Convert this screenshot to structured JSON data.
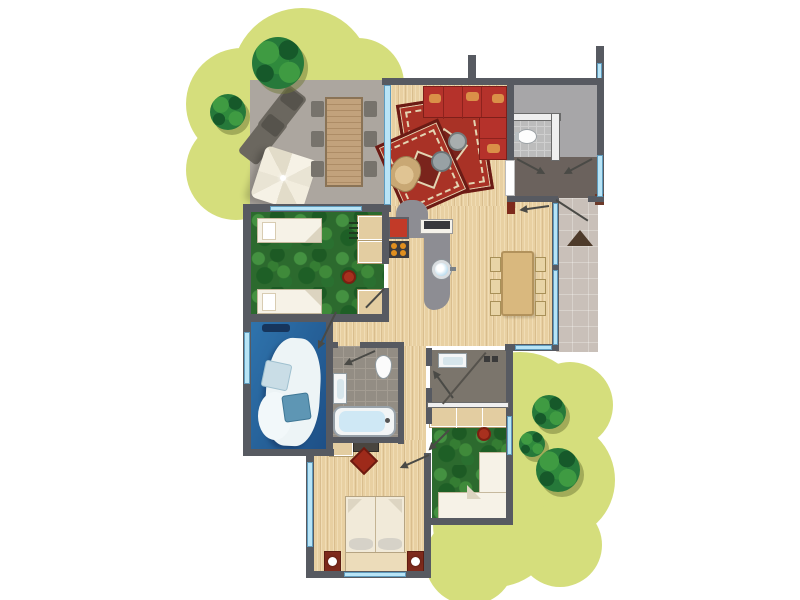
{
  "document": {
    "type": "holiday-home floor plan, top-down illustrated view",
    "visible_text": []
  },
  "palette": {
    "background": "#ffffff",
    "garden": "#d5de7c",
    "tree": "#26793a",
    "terrace_floor": "#aca69f",
    "wall": "#575a61",
    "window": "#b8e4f6",
    "wood_floor": "#e8d0a2",
    "green_carpet": "#2c6a2e",
    "blue_carpet": "#2b6aa6",
    "tile_light": "#938d84",
    "tile_dark": "#7b756c",
    "wc_tile": "#bcbcbc",
    "hallway": "#6b625d",
    "entry_room": "#a7a6a8",
    "path": "#c9c0b9",
    "sofa_red": "#b5322b",
    "accent_red": "#a8301e",
    "furniture_tan": "#e3cda1",
    "fixture_white": "#f6f2e7"
  },
  "outdoor": {
    "garden_areas": 2,
    "trees": 5,
    "terrace": {
      "label": "terrace",
      "furniture": [
        "lounger",
        "lounger",
        "parasol",
        "garden table",
        "six garden chairs"
      ]
    },
    "entrance_path": {
      "label": "entrance path",
      "marker": "triangle doormat arrow"
    }
  },
  "rooms": [
    {
      "id": "living-room",
      "label": "living room",
      "floor": "wood",
      "furniture": [
        "red corner sofa",
        "large oriental rug",
        "small oriental rug",
        "round side table",
        "round side table",
        "wicker chair",
        "dark red sideboard"
      ]
    },
    {
      "id": "kitchen",
      "label": "open kitchen",
      "floor": "wood",
      "furniture": [
        "grey counter",
        "round sink",
        "four-burner hob",
        "red appliance",
        "white cabinet with dark top"
      ]
    },
    {
      "id": "dining-area",
      "label": "dining area",
      "floor": "wood",
      "furniture": [
        "dining table",
        "six chairs"
      ]
    },
    {
      "id": "entry-room",
      "label": "entry/storage room",
      "floor": "grey",
      "furniture": []
    },
    {
      "id": "wc",
      "label": "toilet room",
      "floor": "tile",
      "fixtures": [
        "toilet"
      ]
    },
    {
      "id": "hallway",
      "label": "hallway",
      "floor": "dark taupe",
      "fixtures": [
        "front door",
        "two interior doors"
      ]
    },
    {
      "id": "bedroom-1",
      "label": "bedroom with two single beds",
      "floor": "green carpet",
      "furniture": [
        "single bed",
        "single bed",
        "wardrobe blocks",
        "red stool",
        "ladder"
      ]
    },
    {
      "id": "bedroom-2",
      "label": "bedroom with blue carpet",
      "floor": "blue carpet",
      "furniture": [
        "double bed with white duvet",
        "light pillow",
        "blue pillow",
        "headboard"
      ]
    },
    {
      "id": "bathroom-1",
      "label": "bathroom with bathtub",
      "floor": "tile",
      "fixtures": [
        "bathtub",
        "toilet",
        "washbasin"
      ]
    },
    {
      "id": "bathroom-2",
      "label": "shower room",
      "floor": "tile",
      "fixtures": [
        "washbasin",
        "shower",
        "glass screen"
      ]
    },
    {
      "id": "bedroom-3",
      "label": "bedroom with corner bed",
      "floor": "green carpet",
      "furniture": [
        "corner bed",
        "wardrobe row",
        "red stool"
      ]
    },
    {
      "id": "bedroom-4",
      "label": "master bedroom",
      "floor": "wood",
      "furniture": [
        "double bed",
        "red nightstand with lamp",
        "red nightstand with lamp",
        "dresser",
        "vanity cabinet",
        "red diamond rug"
      ]
    }
  ]
}
